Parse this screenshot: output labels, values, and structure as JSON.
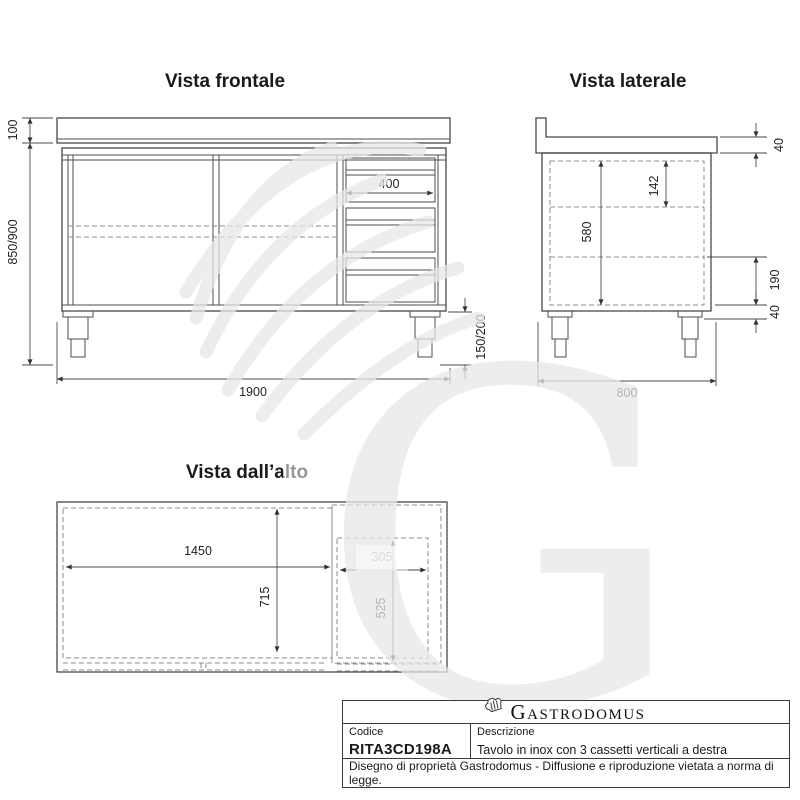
{
  "views": {
    "front": {
      "title": "Vista frontale",
      "dims": {
        "backsplash_h": "100",
        "body_h": "850/900",
        "width": "1900",
        "drawer_w": "400",
        "leg_h": "150/200"
      }
    },
    "side": {
      "title": "Vista laterale",
      "dims": {
        "top_thickness": "40",
        "drawer_front_h": "142",
        "inner_h": "580",
        "lower_gap": "190",
        "frame_h": "40",
        "depth": "800"
      }
    },
    "top": {
      "title": "Vista dall’alto",
      "dims": {
        "inner_w": "1450",
        "inner_d": "715",
        "drawer_w": "305",
        "drawer_d": "525"
      }
    }
  },
  "watermark": {
    "letter": "G"
  },
  "title_block": {
    "brand": "Gastrodomus",
    "code_label": "Codice",
    "code_value": "RITA3CD198A",
    "desc_label": "Descrizione",
    "desc_value": "Tavolo in inox con 3 cassetti verticali a destra",
    "note": "Disegno di proprietà Gastrodomus - Diffusione e riproduzione vietata a norma di legge."
  }
}
